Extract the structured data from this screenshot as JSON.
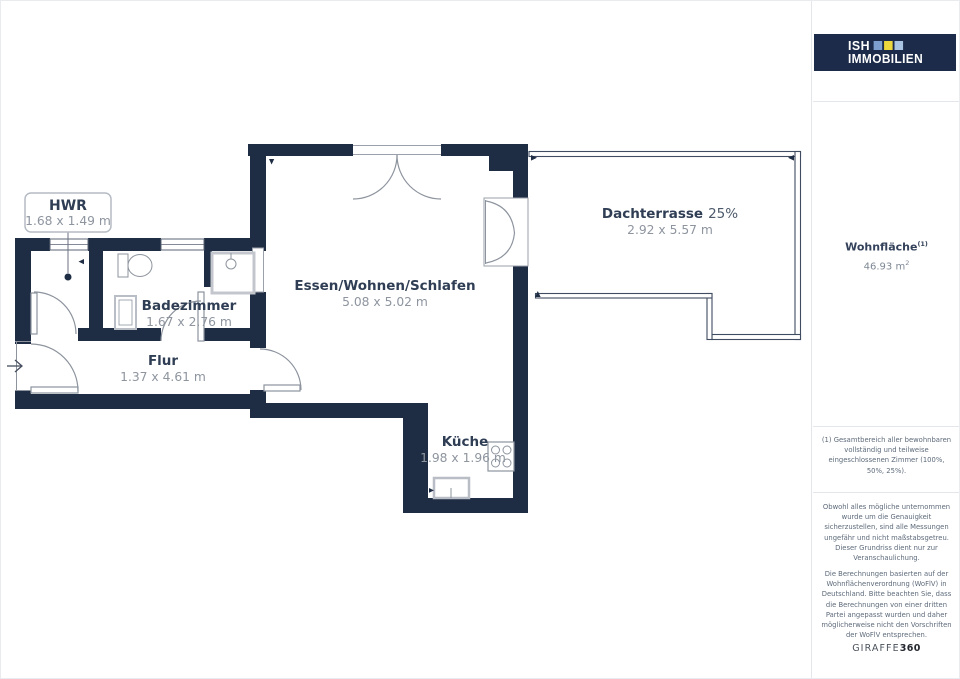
{
  "plan": {
    "rooms": {
      "hwr": {
        "name": "HWR",
        "dims": "1.68 x 1.49 m"
      },
      "bad": {
        "name": "Badezimmer",
        "dims": "1.67 x 2.76 m"
      },
      "flur": {
        "name": "Flur",
        "dims": "1.37 x 4.61 m"
      },
      "wohnen": {
        "name": "Essen/Wohnen/Schlafen",
        "dims": "5.08 x 5.02 m"
      },
      "kueche": {
        "name": "Küche",
        "dims": "1.98 x 1.96 m"
      },
      "terrasse": {
        "name": "Dachterrasse",
        "share": "25%",
        "dims": "2.92 x 5.57 m"
      }
    },
    "colors": {
      "wall": "#1e2c44",
      "room_label": "#2f3e54",
      "dims_label": "#8e959f",
      "fixture_line": "#8d949e"
    }
  },
  "sidebar": {
    "logo": {
      "word1": "ISH",
      "word2": "IMMOBILIEN",
      "bg": "#1c2b49",
      "square_colors": [
        "#7d9fd0",
        "#ecd73c",
        "#a9c3e2"
      ]
    },
    "living_area": {
      "label": "Wohnfläche",
      "footnote_ref": "(1)",
      "value": "46.93 m",
      "unit_sup": "2"
    },
    "footnote": "(1) Gesamtbereich aller bewohnbaren vollständig und teilweise eingeschlossenen Zimmer (100%, 50%, 25%).",
    "disclaimer_accuracy": "Obwohl alles mögliche unternommen wurde um die Genauigkeit sicherzustellen, sind alle Messungen ungefähr und nicht maßstabsgetreu. Dieser Grundriss dient nur zur Veranschaulichung.",
    "disclaimer_calculation": "Die Berechnungen basierten auf der Wohnflächenverordnung (WoFlV) in Deutschland. Bitte beachten Sie, dass die Berechnungen von einer dritten Partei angepasst wurden und daher möglicherweise nicht den Vorschriften der WoFlV entsprechen.",
    "brand": {
      "name": "GIRAFFE",
      "number": "360"
    }
  }
}
